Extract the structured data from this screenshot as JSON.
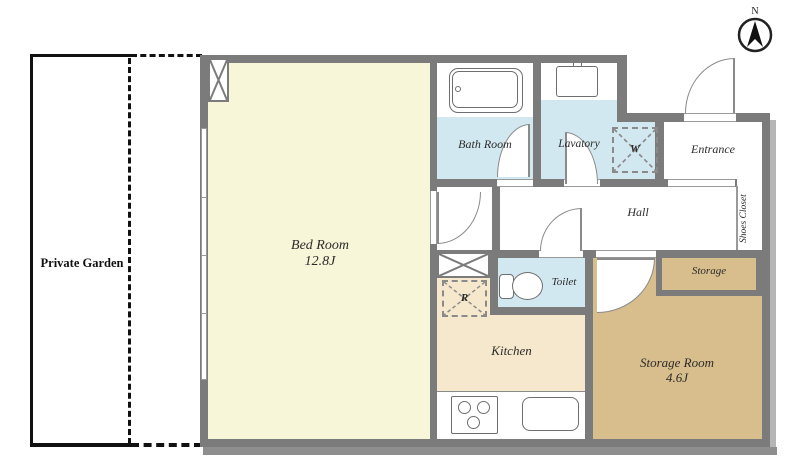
{
  "compass": {
    "label": "N"
  },
  "rooms": {
    "private_garden": {
      "label": "Private Garden"
    },
    "bed_room": {
      "label": "Bed Room",
      "size": "12.8J"
    },
    "bath_room": {
      "label": "Bath Room"
    },
    "lavatory": {
      "label": "Lavatory"
    },
    "washer_box": {
      "label": "W"
    },
    "entrance": {
      "label": "Entrance"
    },
    "hall": {
      "label": "Hall"
    },
    "shoes_closet": {
      "label": "Shoes Closet"
    },
    "toilet": {
      "label": "Toilet"
    },
    "refrigerator_box": {
      "label": "R"
    },
    "kitchen": {
      "label": "Kitchen"
    },
    "storage": {
      "label": "Storage"
    },
    "storage_room": {
      "label": "Storage Room",
      "size": "4.6J"
    }
  },
  "colors": {
    "wall": "#7b7b7b",
    "bedroom_floor": "#f8f6d9",
    "wet_area_floor": "#d2e8f1",
    "kitchen_floor": "#f6e8cd",
    "storage_floor": "#d8be8c",
    "hall_floor": "#ffffff",
    "outline": "#111111"
  }
}
